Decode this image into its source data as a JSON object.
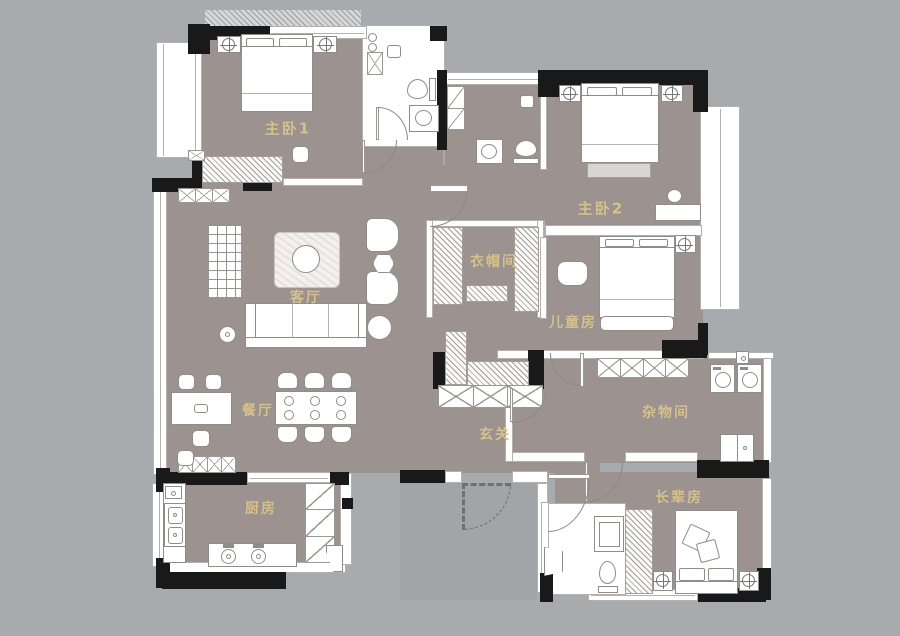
{
  "rooms": {
    "master1": {
      "label": "主卧1"
    },
    "master2": {
      "label": "主卧2"
    },
    "cloakroom": {
      "label": "衣帽间"
    },
    "kids": {
      "label": "儿童房"
    },
    "living": {
      "label": "客厅"
    },
    "dining": {
      "label": "餐厅"
    },
    "foyer": {
      "label": "玄关"
    },
    "storage": {
      "label": "杂物间"
    },
    "elder": {
      "label": "长辈房"
    },
    "kitchen": {
      "label": "厨房"
    }
  },
  "colors": {
    "background": "#a8abae",
    "floor": "#9c9390",
    "wall": "#191919",
    "label_gold": "#d6c18f",
    "fixture_white": "#ffffff"
  }
}
